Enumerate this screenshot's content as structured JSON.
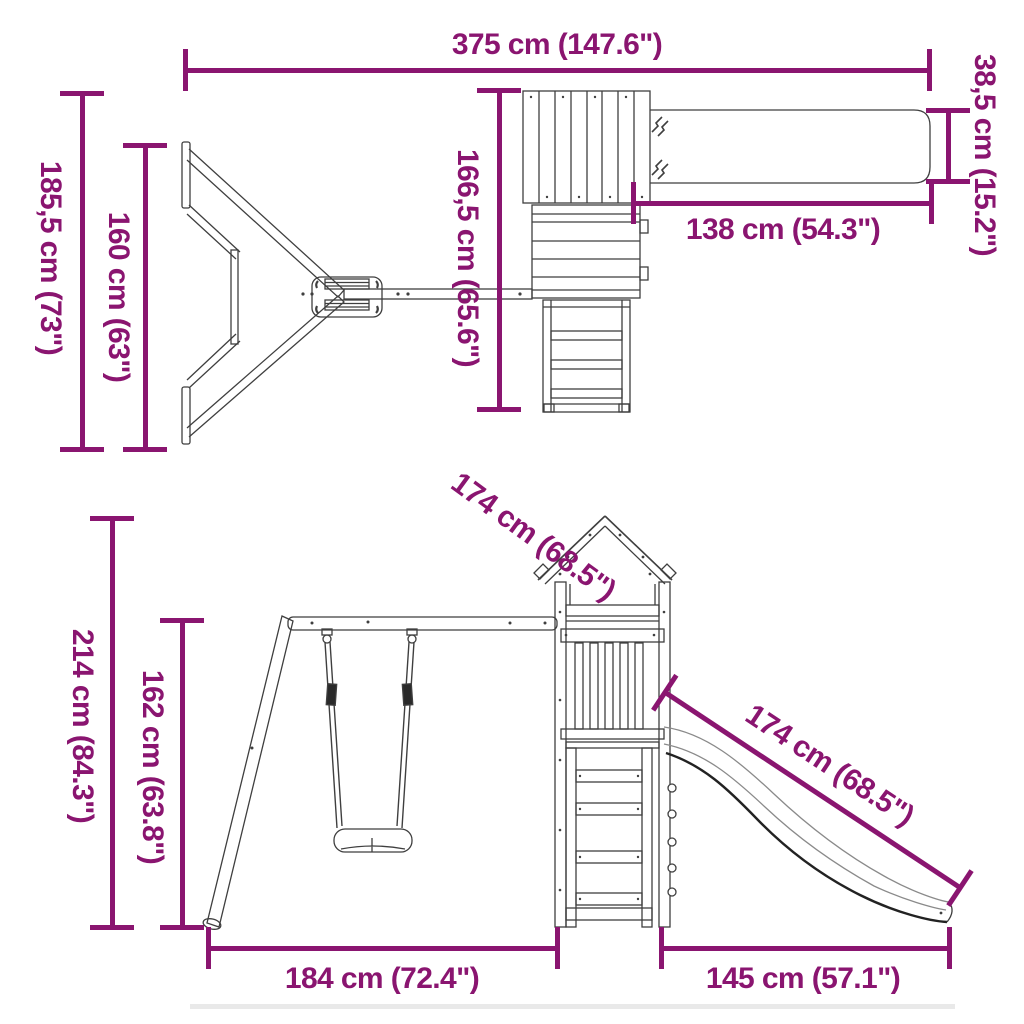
{
  "diagram": {
    "type": "product-dimension-drawing",
    "subject": "wooden playset with tower, slide and swing (top view and side view)",
    "accent_color": "#8A1570",
    "line_color": "#3f3f3f"
  },
  "dims": {
    "total_width": "375 cm (147.6\")",
    "total_depth": "185,5 cm (73\")",
    "swing_depth": "160 cm (63\")",
    "tower_depth": "166,5 cm (65.6\")",
    "slide_top_length": "138 cm (54.3\")",
    "slide_width": "38,5 cm (15.2\")",
    "diagonal_mid": "174 cm (68.5\")",
    "total_height": "214 cm (84.3\")",
    "beam_height": "162 cm (63.8\")",
    "slide_length": "174 cm (68.5\")",
    "swing_base_width": "184 cm (72.4\")",
    "slide_base_width": "145 cm (57.1\")"
  }
}
